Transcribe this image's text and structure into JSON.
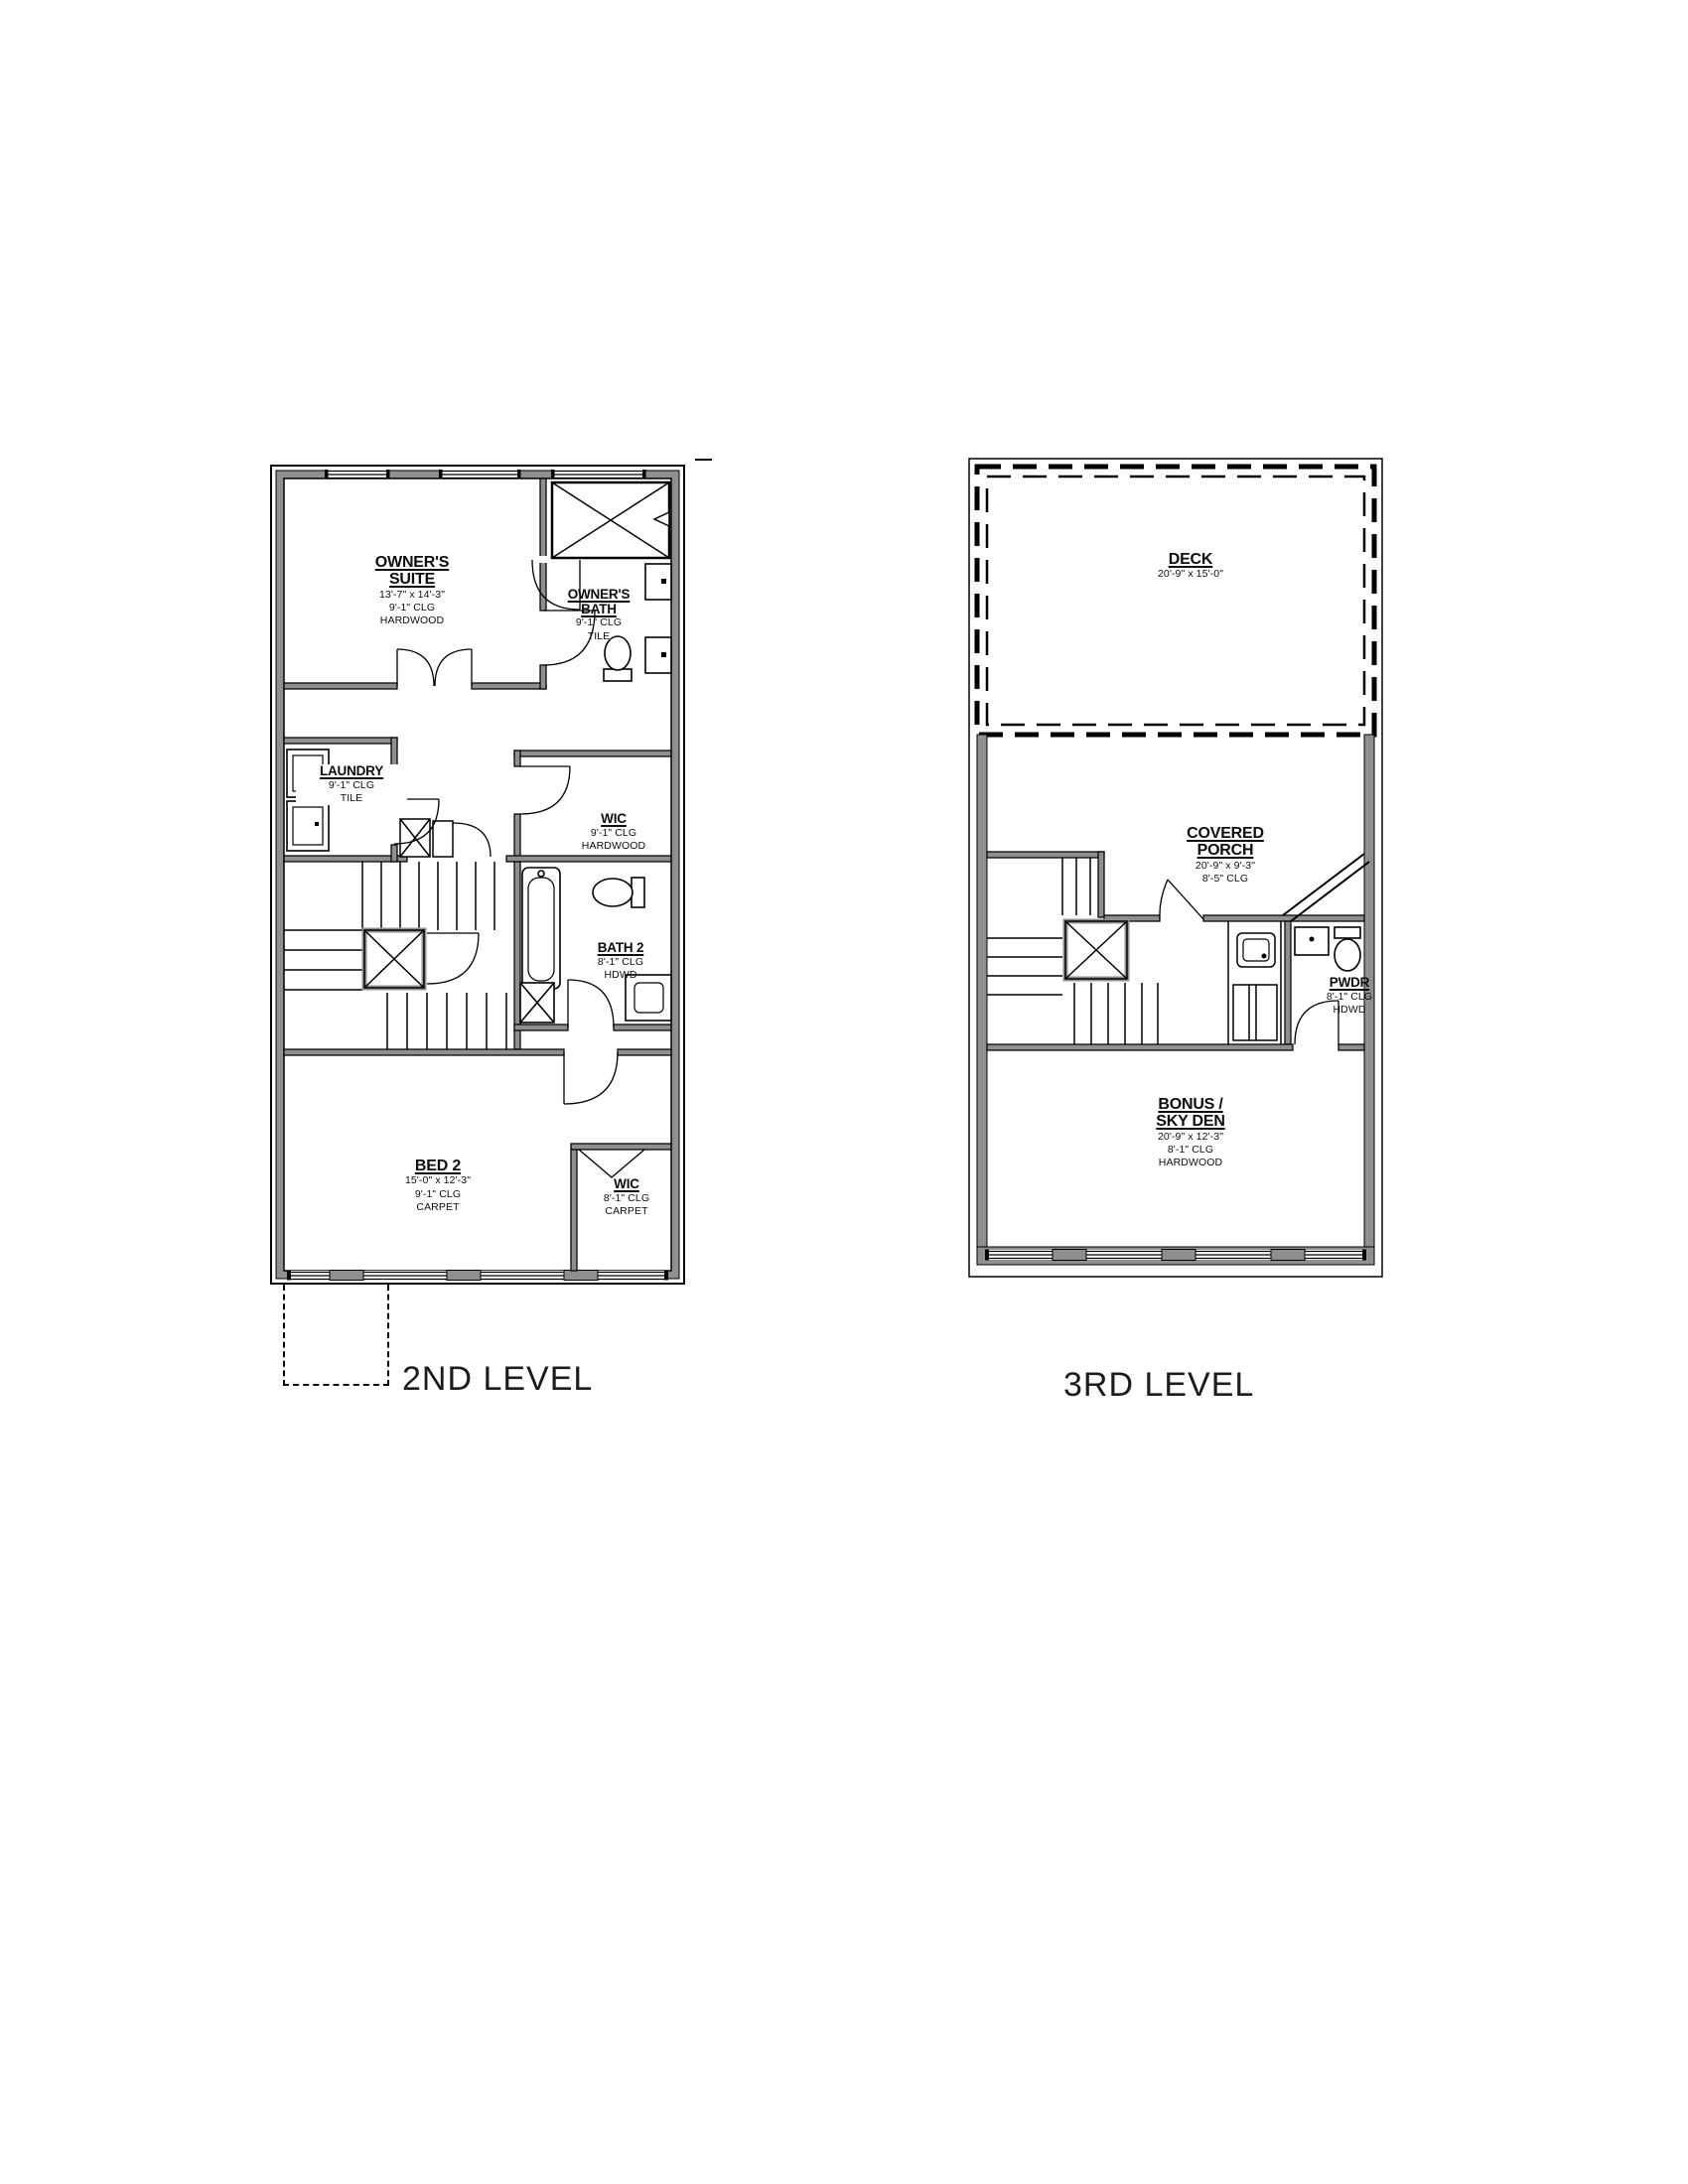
{
  "colors": {
    "wall_fill": "#8f8f8f",
    "line": "#000000",
    "background": "#ffffff"
  },
  "plans": {
    "level2": {
      "label": "2ND LEVEL",
      "rooms": {
        "owners_suite": {
          "name": "OWNER'S SUITE",
          "dims": "13'-7\" x 14'-3\"",
          "ceiling": "9'-1\" CLG",
          "floor": "HARDWOOD"
        },
        "owners_bath": {
          "name": "OWNER'S BATH",
          "ceiling": "9'-1\" CLG",
          "floor": "TILE"
        },
        "laundry": {
          "name": "LAUNDRY",
          "ceiling": "9'-1\" CLG",
          "floor": "TILE"
        },
        "wic_upper": {
          "name": "WIC",
          "ceiling": "9'-1\" CLG",
          "floor": "HARDWOOD"
        },
        "bath_2": {
          "name": "BATH 2",
          "ceiling": "8'-1\" CLG",
          "floor": "HDWD"
        },
        "bed_2": {
          "name": "BED 2",
          "dims": "15'-0\" x 12'-3\"",
          "ceiling": "9'-1\" CLG",
          "floor": "CARPET"
        },
        "wic_lower": {
          "name": "WIC",
          "ceiling": "8'-1\" CLG",
          "floor": "CARPET"
        }
      }
    },
    "level3": {
      "label": "3RD LEVEL",
      "rooms": {
        "deck": {
          "name": "DECK",
          "dims": "20'-9\" x 15'-0\""
        },
        "covered_porch": {
          "name_line1": "COVERED",
          "name_line2": "PORCH",
          "dims": "20'-9\" x 9'-3\"",
          "ceiling": "8'-5\" CLG"
        },
        "pwdr": {
          "name": "PWDR",
          "ceiling": "8'-1\" CLG",
          "floor": "HDWD"
        },
        "bonus_sky_den": {
          "name_line1": "BONUS /",
          "name_line2": "SKY DEN",
          "dims": "20'-9\" x 12'-3\"",
          "ceiling": "8'-1\" CLG",
          "floor": "HARDWOOD"
        }
      }
    }
  }
}
